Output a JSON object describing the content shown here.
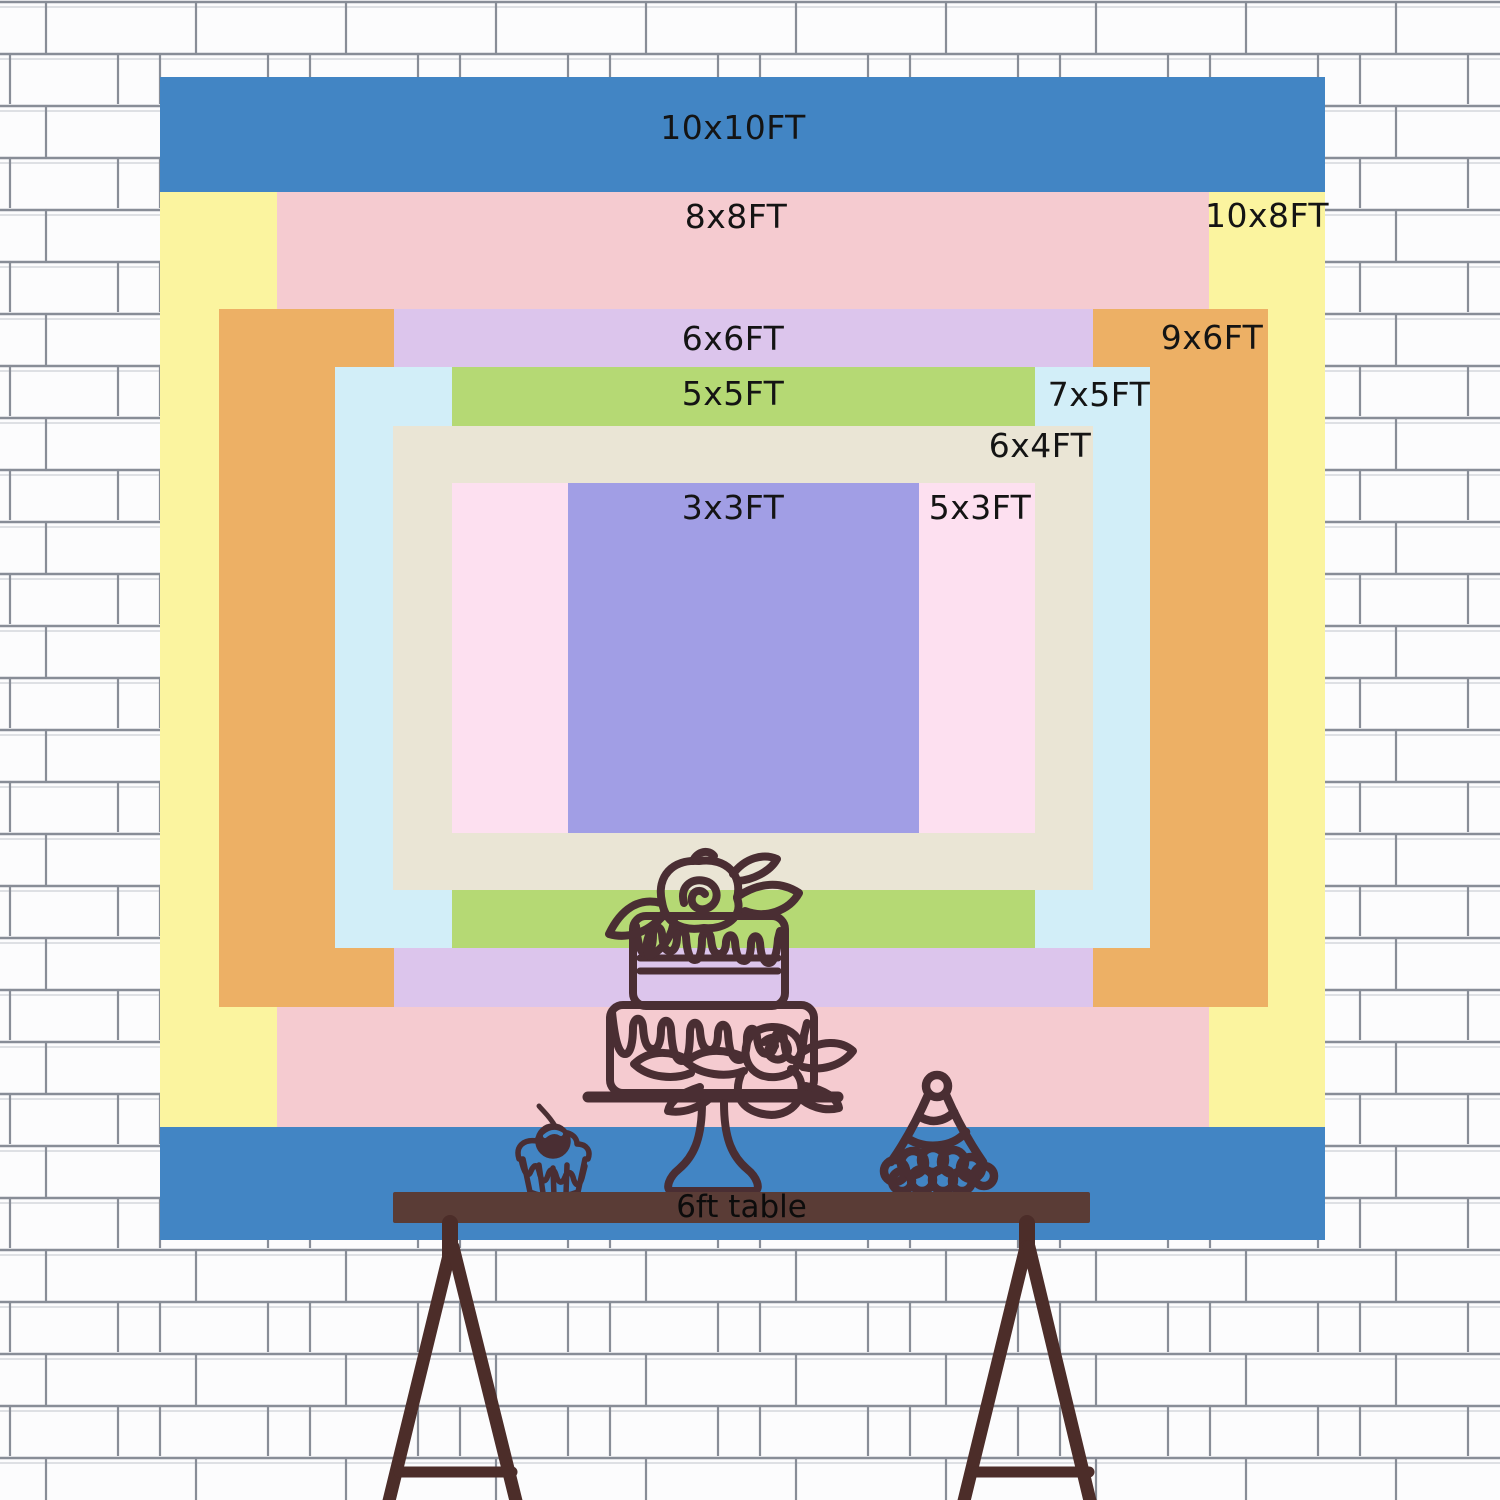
{
  "scene": {
    "description": "Backdrop size comparison chart on a white brick wall with a cake table"
  },
  "sizes": [
    {
      "label": "10x10FT",
      "color": "#4285c4"
    },
    {
      "label": "10x8FT",
      "color": "#fbf49f"
    },
    {
      "label": "8x8FT",
      "color": "#f5cbd0"
    },
    {
      "label": "9x6FT",
      "color": "#edb065"
    },
    {
      "label": "6x6FT",
      "color": "#dcc5ec"
    },
    {
      "label": "7x5FT",
      "color": "#d2eef8"
    },
    {
      "label": "5x5FT",
      "color": "#b5d974"
    },
    {
      "label": "6x4FT",
      "color": "#eae5d5"
    },
    {
      "label": "5x3FT",
      "color": "#fde0f0"
    },
    {
      "label": "3x3FT",
      "color": "#a19ee5"
    }
  ],
  "table": {
    "label": "6ft table",
    "bar_color": "#5a3c36",
    "leg_color": "#4c2d29"
  },
  "art": {
    "line_color": "#4a2e33",
    "cherry_highlight": "#4285c4",
    "cake": "two-tier-cake-icon",
    "cupcake": "cupcake-icon",
    "party_hat": "party-hat-icon"
  },
  "wall": {
    "brick_fill": "#fcfcfd",
    "brick_line_color": "#888d97",
    "brick_faint_line_color": "#cdd0d6"
  }
}
